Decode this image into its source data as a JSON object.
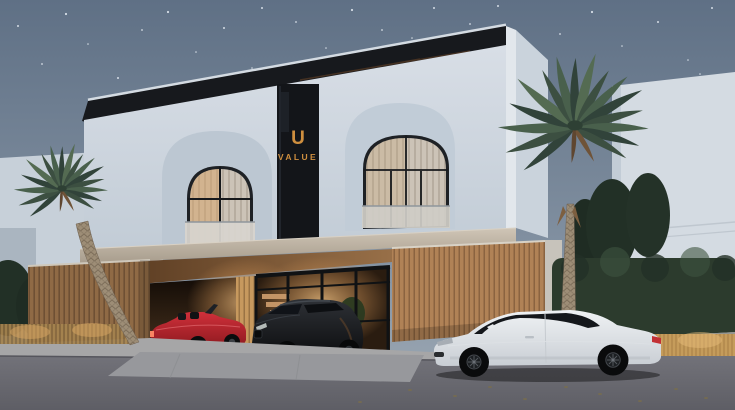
{
  "scene": {
    "description": "Dusk architectural rendering of a modern two-storey villa with arched windows, a central dark glazing strip bearing the U VALUE logo, a timber-slat carport sheltering a red convertible and a dark SUV, a white coupe parked on the street, palm trees, hedges and neighbouring white buildings under a starry blue-grey sky",
    "time_of_day": "dusk",
    "objects": [
      "starry sky",
      "left neighbour building",
      "right neighbour building",
      "main villa",
      "arched window left",
      "arched window right",
      "logo glazing strip",
      "concrete band",
      "timber carport",
      "red convertible",
      "dark suv",
      "entrance glazing",
      "interior staircase",
      "interior plant",
      "white coupe",
      "palm tree left",
      "palm tree right",
      "pine trees",
      "hedge",
      "ornamental grasses",
      "sidewalk",
      "driveway",
      "street"
    ]
  },
  "branding": {
    "logo_glyph": "U",
    "logo_text": "VALUE"
  },
  "colors": {
    "sky_top": "#5f7085",
    "sky_mid": "#7e8d9e",
    "sky_bottom": "#9fabb6",
    "star": "#e9eff6",
    "building_light": "#d8dee6",
    "building_mid": "#c2ccd6",
    "building_shadow": "#aeb9c6",
    "building_far": "#d4dbe2",
    "roof_dark": "#17191d",
    "logo_panel": "#131519",
    "logo_gold": "#cf8f3f",
    "band_light": "#cfc5b6",
    "band_dark": "#a79c8c",
    "wood_base": "#8f6a45",
    "wood_line": "#6e5034",
    "wood_light": "#b08256",
    "wood_lit": "#c7995e",
    "ceiling_dark": "#56381f",
    "ceiling_light": "#b08457",
    "garage_dark": "#120b06",
    "glow_warm": "#f0c183",
    "window_dark": "#1e2125",
    "curtain_light": "#d3cabd",
    "car_red": "#d0303a",
    "car_dark": "#2e3136",
    "car_white": "#eff2f4",
    "asphalt": "#6d6d74",
    "sidewalk": "#a6a6a7",
    "hedge_green": "#2c3b2d",
    "pine_green": "#223026",
    "palm_green": "#43573f",
    "palm_trunk": "#9d8d76",
    "grass_gold": "#b68d50"
  }
}
